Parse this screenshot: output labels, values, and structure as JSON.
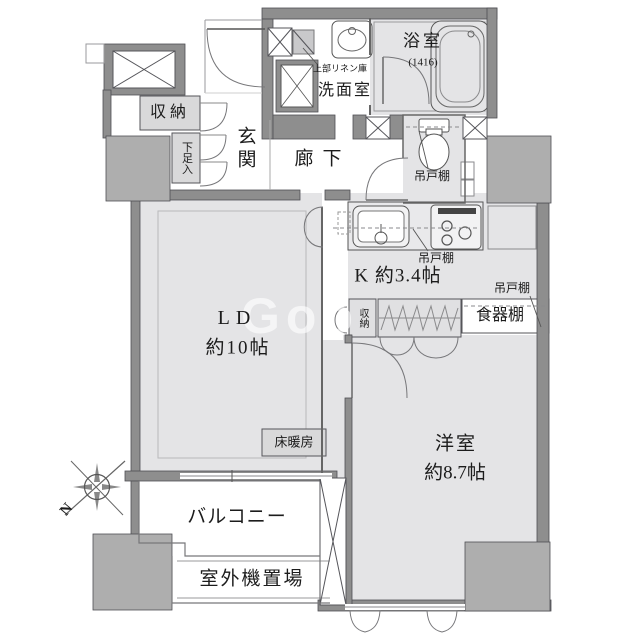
{
  "rooms": {
    "bath": {
      "label": "浴室",
      "size": "(1416)"
    },
    "washroom": {
      "label": "洗面室",
      "linen_note": "上部リネン庫"
    },
    "entrance": {
      "label": "玄関"
    },
    "entrance_storage": {
      "label": "収納"
    },
    "shoe_cabinet": {
      "label": "下足入"
    },
    "hallway": {
      "label": "廊下"
    },
    "toilet": {
      "shelf_label": "吊戸棚"
    },
    "kitchen": {
      "label": "K 約3.4帖",
      "shelf_label": "吊戸棚"
    },
    "pantry": {
      "shelf_label": "吊戸棚",
      "cupboard_label": "食器棚"
    },
    "passage_storage": {
      "label": "収納"
    },
    "living_dining": {
      "label": "LD",
      "size": "約10帖",
      "floor_heating": "床暖房"
    },
    "western_room": {
      "label": "洋室",
      "size": "約8.7帖"
    },
    "balcony": {
      "label": "バルコニー"
    },
    "outdoor_unit": {
      "label": "室外機置場"
    }
  },
  "compass": {
    "north_label": "N"
  },
  "watermark": {
    "text": "Goo"
  },
  "colors": {
    "wall": "#8e8e8e",
    "pillar": "#aeaeae",
    "floor": "#e4e4e6",
    "box_fill": "#d9d9da"
  }
}
